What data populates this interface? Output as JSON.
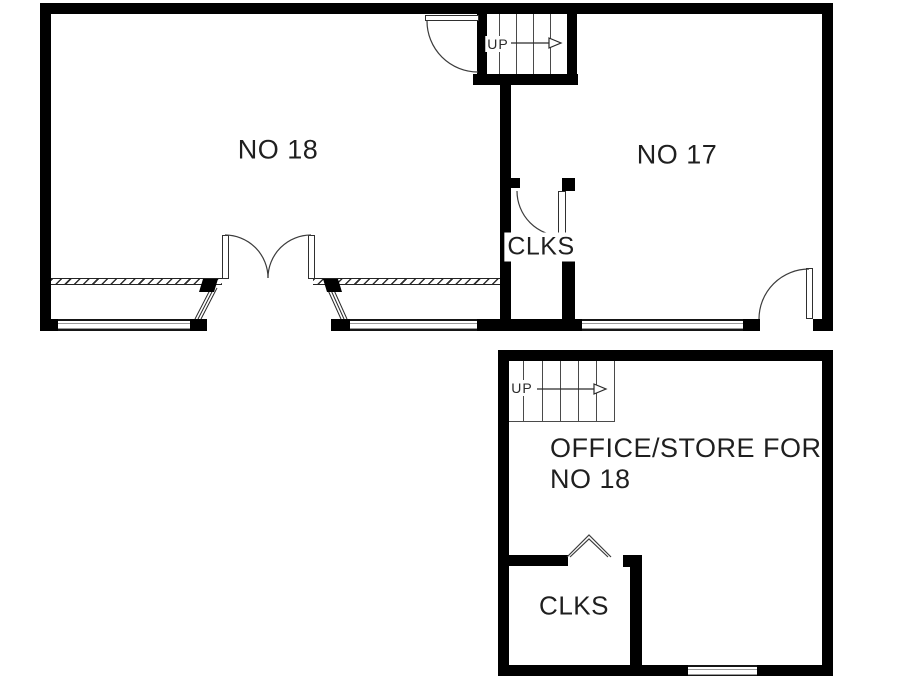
{
  "document": {
    "type": "architectural floor plan",
    "background_color": "#ffffff"
  },
  "colors": {
    "wall": "#000000",
    "thin_line": "#3c3c3c",
    "glazing_mid_line": "#9a9a9a",
    "text": "#1f1f1f"
  },
  "upper_plan": {
    "room_left_label": "NO 18",
    "room_right_label": "NO 17",
    "cupboard_label": "CLKS",
    "stairs_label": "UP"
  },
  "lower_plan": {
    "room_label_line1": "OFFICE/STORE FOR",
    "room_label_line2": "NO 18",
    "cupboard_label": "CLKS",
    "stairs_label": "UP"
  }
}
